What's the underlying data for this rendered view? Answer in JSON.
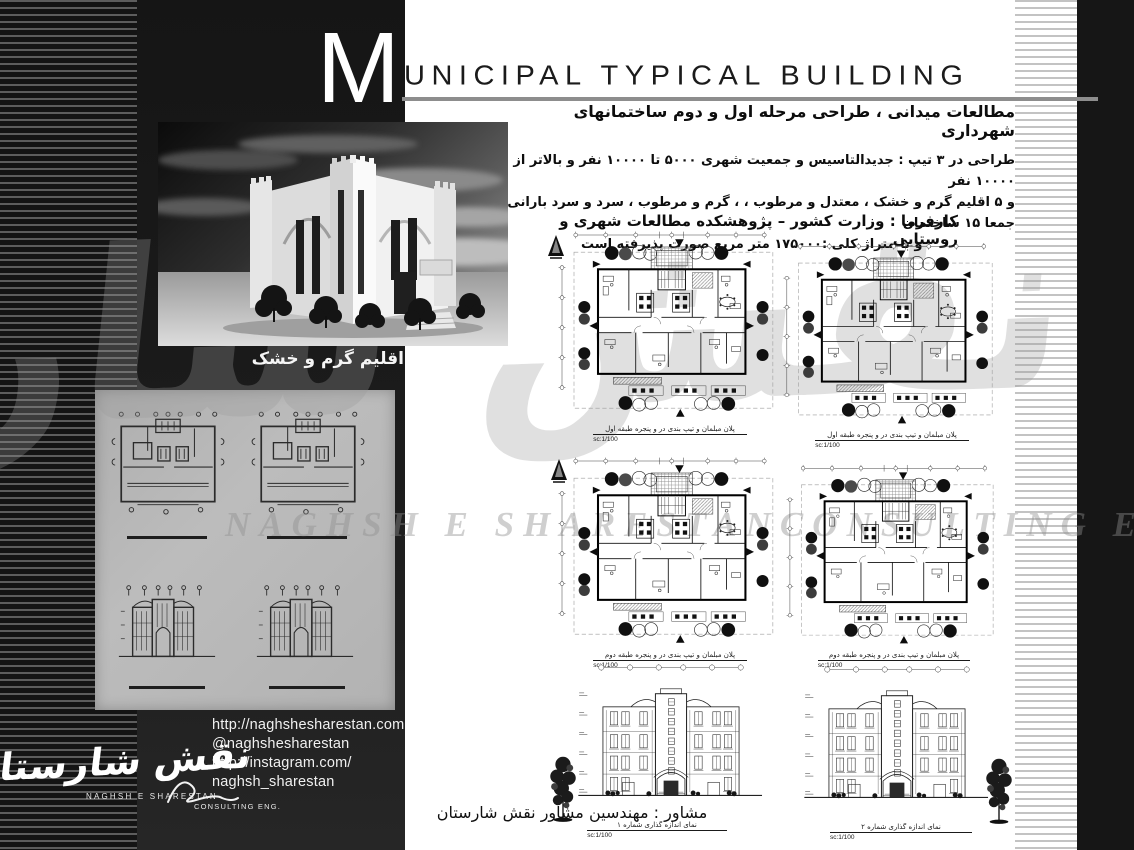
{
  "title": {
    "initial": "M",
    "rest": "UNICIPAL TYPICAL BUILDING"
  },
  "intro": {
    "line1": "مطالعات میدانی ، طراحی مرحله اول و دوم ساختمانهای  شهرداری",
    "line2": "طراحی در ۳ تیپ : جدیدالتاسیس و جمعیت شهری ۵۰۰۰ تا ۱۰۰۰۰ نفر و بالاتر از ۱۰۰۰۰ نفر",
    "line3": "و ۵ اقلیم گرم و خشک ، معتدل و مرطوب ، ، گرم و مرطوب ، سرد و سرد بارانی جمعا ۱۵ ساختمان",
    "line4": ". و با متراژ کلی  :۱۷۵۰۰۰ متر مربع صورت پذیرفته است",
    "client": "کارفرما : وزارت کشور – پژوهشکده مطالعات شهری و روستایی",
    "consultant": "مشاور : مهندسین مشاور نقش شارستان"
  },
  "render": {
    "caption": "اقلیم گرم و خشک"
  },
  "drawings": {
    "plan_floor1_caption": "پلان مبلمان و تیپ بندی در و پنجره طبقه اول",
    "plan_floor2_caption": "پلان مبلمان و تیپ بندی در و پنجره طبقه دوم",
    "elevation1_caption": "نمای اندازه گذاری شماره ۱",
    "elevation2_caption": "نمای اندازه گذاری شماره ۲",
    "scale": "sc:1/100"
  },
  "contact": {
    "website": "http://naghshesharestan.com",
    "handle": "@naghshesharestan",
    "instagram_line1": "http://instagram.com/",
    "instagram_line2": "naghsh_sharestan"
  },
  "logo": {
    "calligraphy": "نقش شارستان",
    "name_latin": "NAGHSH  E  SHARESTAN",
    "type_latin": "CONSULTING ENG."
  },
  "watermark": {
    "calligraphy": "نقش شارستان",
    "latin_left": "NAGHSH  E  SHARESTAN",
    "latin_right": "CONSULTING ENG."
  },
  "colors": {
    "band_dark": "#161616",
    "page_bg": "#ffffff",
    "panel_gray": "#b6b6b6"
  }
}
